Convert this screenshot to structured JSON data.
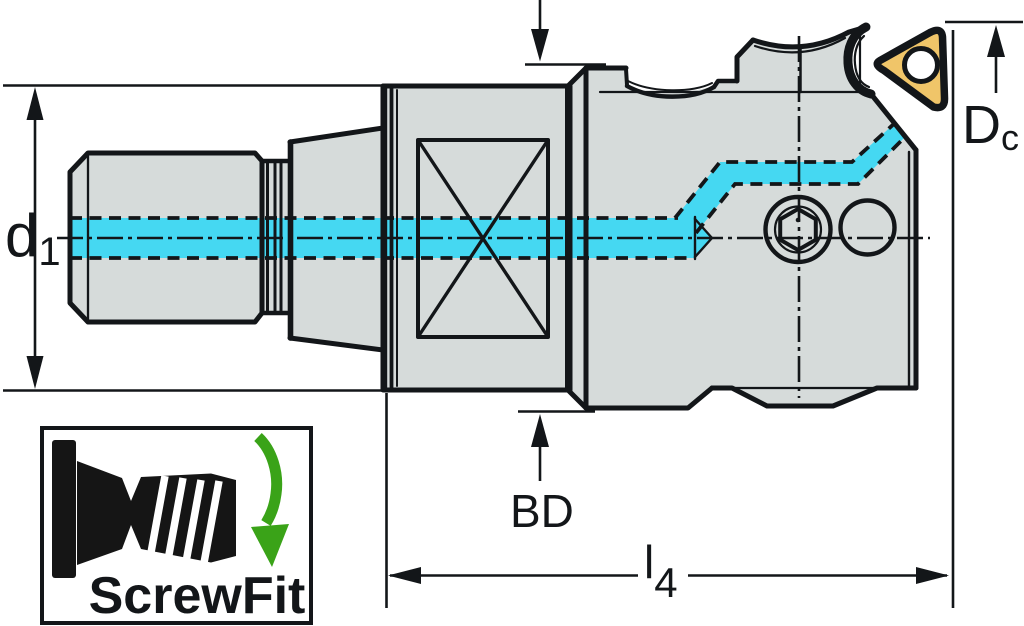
{
  "drawing": {
    "type": "technical-drawing",
    "dimension_labels": {
      "d1": {
        "base": "d",
        "sub": "1"
      },
      "Dc": {
        "base": "D",
        "sub": "c"
      },
      "BD": {
        "text": "BD"
      },
      "l4": {
        "base": "l",
        "sub": "4"
      }
    },
    "badge": {
      "label": "ScrewFit"
    },
    "colors": {
      "body_gray": "#d6dbda",
      "outline_black": "#131619",
      "coolant_cyan": "#45d8f2",
      "insert_yellow": "#f0c569",
      "rotation_green": "#3aa318",
      "background": "#ffffff"
    },
    "icons": [
      {
        "name": "screwfit-connector-icon"
      },
      {
        "name": "rotation-arrow-icon"
      }
    ]
  }
}
